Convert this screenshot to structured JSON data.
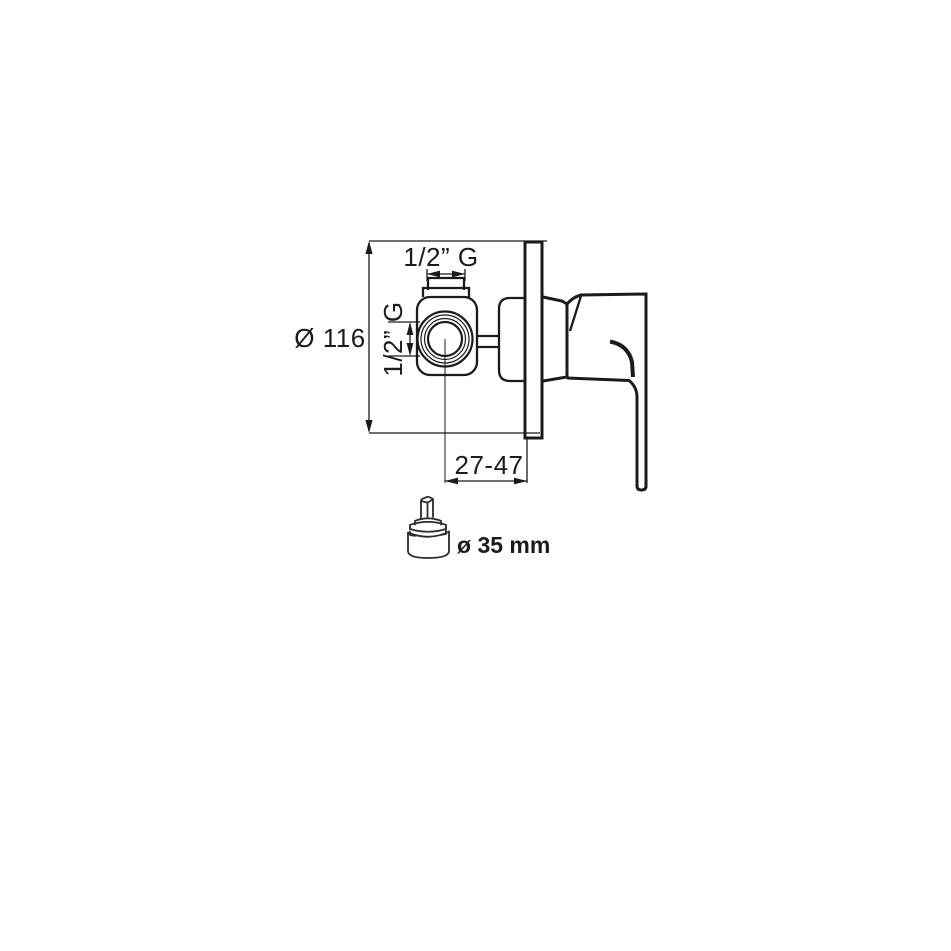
{
  "drawing": {
    "labels": {
      "top_port": "1/2” G",
      "side_port": "1/2” G",
      "plate_diameter": "Ø 116",
      "depth_range": "27-47",
      "cartridge_diameter": "ø 35 mm"
    },
    "colors": {
      "ink": "#1b1b1b",
      "cartridge_ink": "#2c2c2c",
      "background": "#ffffff"
    }
  }
}
